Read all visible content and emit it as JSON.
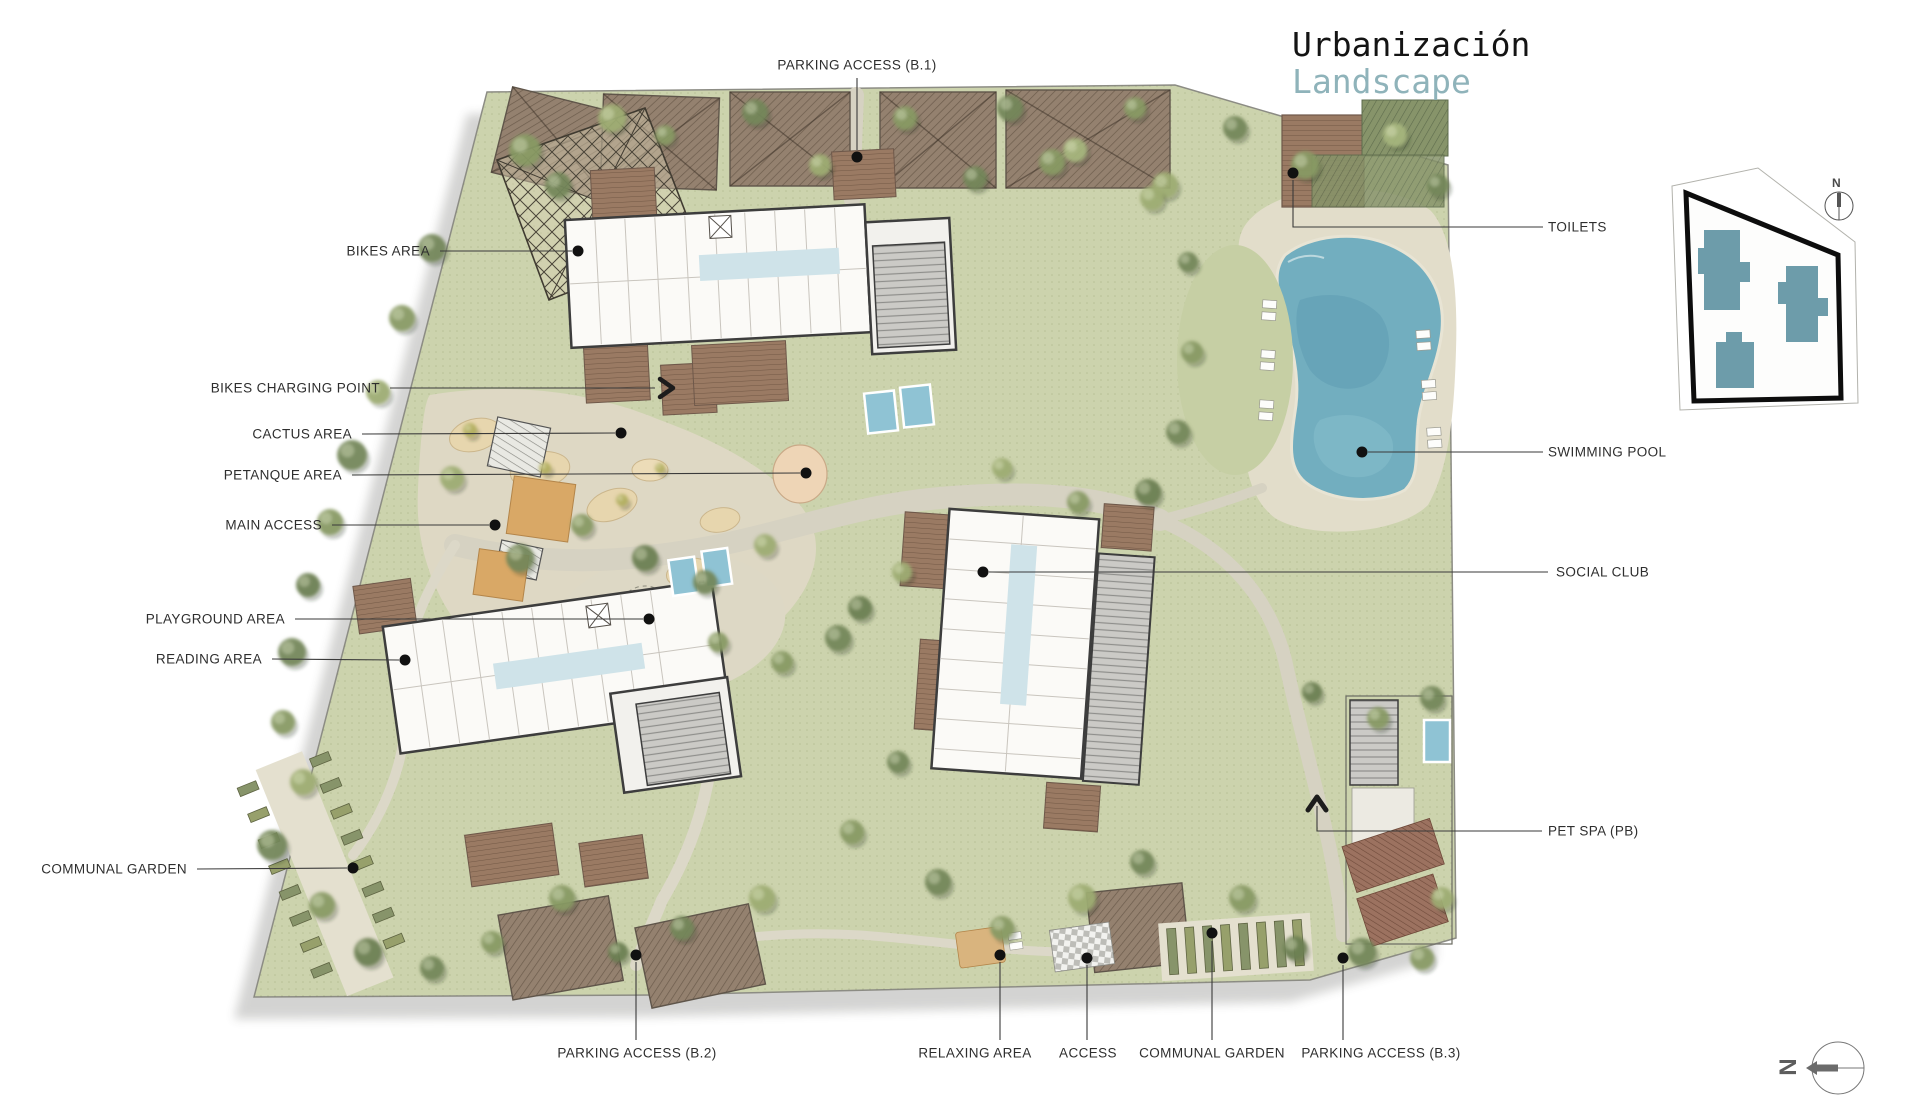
{
  "title": {
    "line1": "Urbanización",
    "line2": "Landscape"
  },
  "plan": {
    "labels": [
      {
        "id": "parking-access-b1",
        "text": "PARKING ACCESS (B.1)"
      },
      {
        "id": "bikes-area",
        "text": "BIKES AREA"
      },
      {
        "id": "bikes-charging-point",
        "text": "BIKES CHARGING POINT"
      },
      {
        "id": "cactus-area",
        "text": "CACTUS AREA"
      },
      {
        "id": "petanque-area",
        "text": "PETANQUE AREA"
      },
      {
        "id": "main-access",
        "text": "MAIN ACCESS"
      },
      {
        "id": "playground-area",
        "text": "PLAYGROUND AREA"
      },
      {
        "id": "reading-area",
        "text": "READING AREA"
      },
      {
        "id": "communal-garden-left",
        "text": "COMMUNAL GARDEN"
      },
      {
        "id": "parking-access-b2",
        "text": "PARKING ACCESS (B.2)"
      },
      {
        "id": "relaxing-area",
        "text": "RELAXING AREA"
      },
      {
        "id": "access",
        "text": "ACCESS"
      },
      {
        "id": "communal-garden-bottom",
        "text": "COMMUNAL GARDEN"
      },
      {
        "id": "parking-access-b3",
        "text": "PARKING ACCESS (B.3)"
      },
      {
        "id": "toilets",
        "text": "TOILETS"
      },
      {
        "id": "swimming-pool",
        "text": "SWIMMING POOL"
      },
      {
        "id": "social-club",
        "text": "SOCIAL CLUB"
      },
      {
        "id": "pet-spa",
        "text": "PET SPA (PB)"
      }
    ]
  },
  "keymap": {
    "north_label": "N"
  },
  "compass": {
    "north_label": "N"
  },
  "colors": {
    "accent_teal": "#8fb3ba",
    "land_green": "#ccd3ad",
    "path_beige": "#ded8c4",
    "pool_teal": "#72aebf",
    "deck_brown": "#9a7a63",
    "keymap_building": "#6d9caa"
  }
}
